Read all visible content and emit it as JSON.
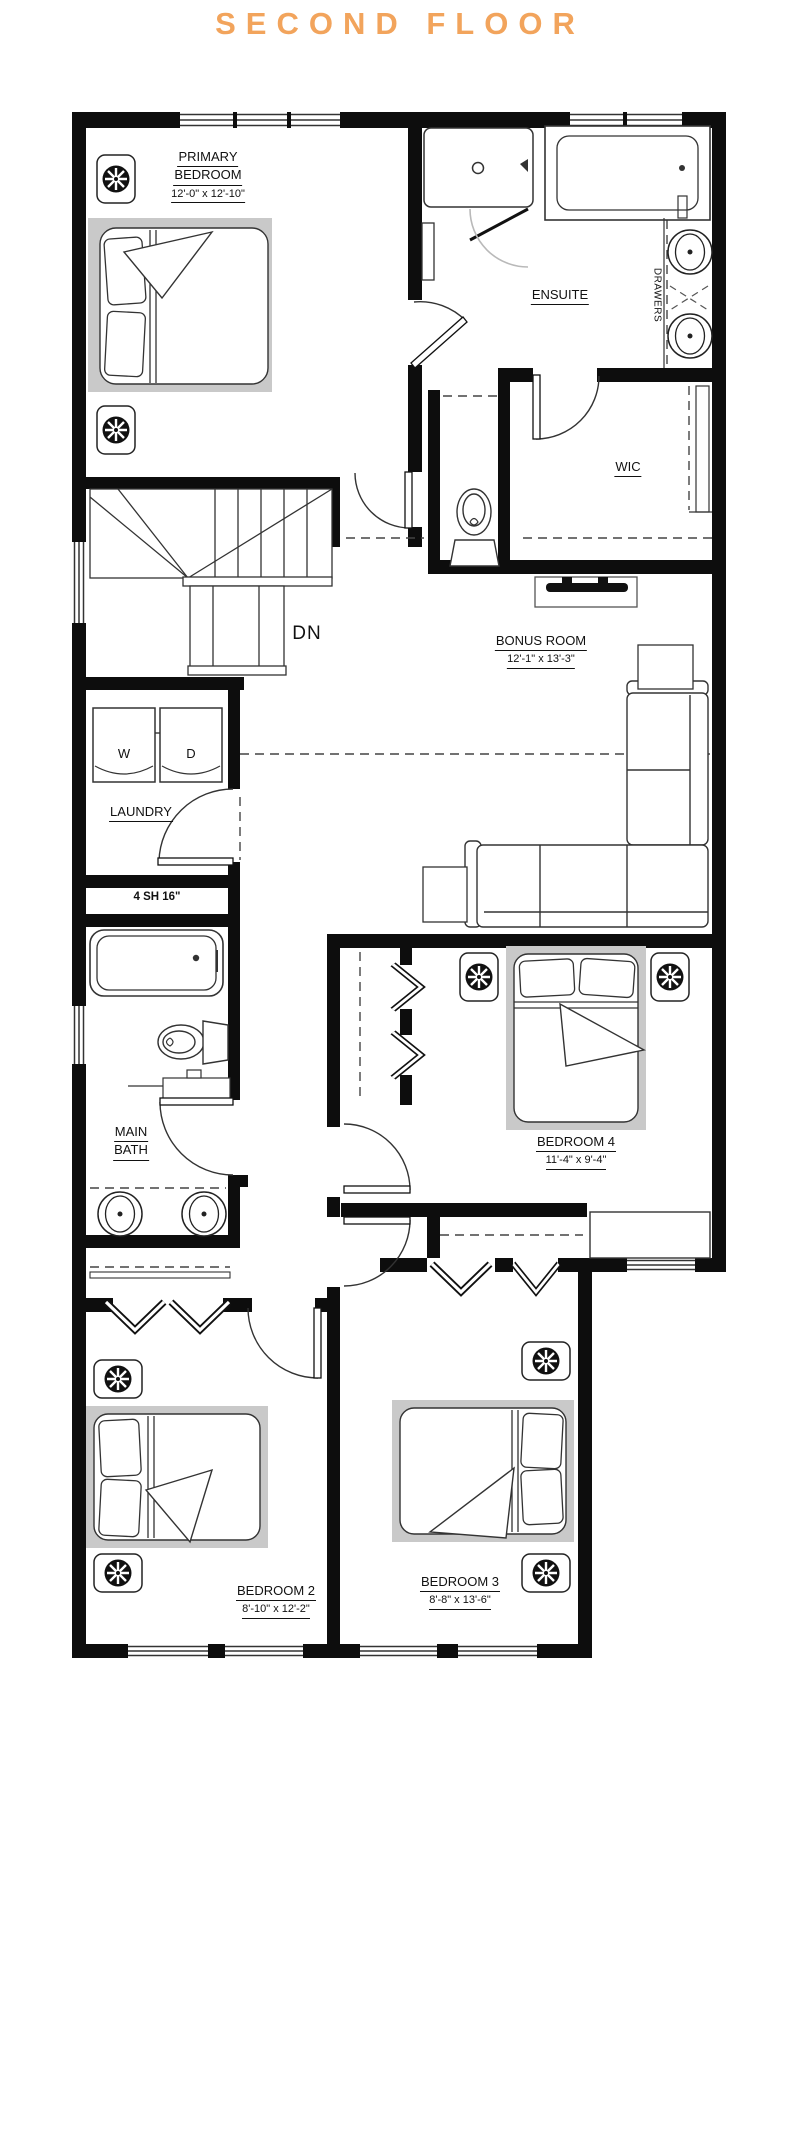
{
  "title": "SECOND FLOOR",
  "accent_color": "#F2A45C",
  "line_color": "#111111",
  "bed_shadow_color": "#c9c9c9",
  "rooms": {
    "primary_bedroom": {
      "name_line1": "PRIMARY",
      "name_line2": "BEDROOM",
      "dims": "12'-0\" x 12'-10\""
    },
    "ensuite": {
      "name": "ENSUITE"
    },
    "wic": {
      "name": "WIC"
    },
    "bonus_room": {
      "name": "BONUS ROOM",
      "dims": "12'-1\" x 13'-3\""
    },
    "laundry": {
      "name": "LAUNDRY"
    },
    "linen_closet": {
      "name": "4 SH 16\""
    },
    "main_bath": {
      "name_line1": "MAIN",
      "name_line2": "BATH"
    },
    "bedroom_4": {
      "name": "BEDROOM 4",
      "dims": "11'-4\" x 9'-4\""
    },
    "bedroom_2": {
      "name": "BEDROOM 2",
      "dims": "8'-10\" x 12'-2\""
    },
    "bedroom_3": {
      "name": "BEDROOM 3",
      "dims": "8'-8\" x 13'-6\""
    }
  },
  "annotations": {
    "stair_direction": "DN",
    "drawers": "DRAWERS",
    "washer": "W",
    "dryer": "D"
  }
}
